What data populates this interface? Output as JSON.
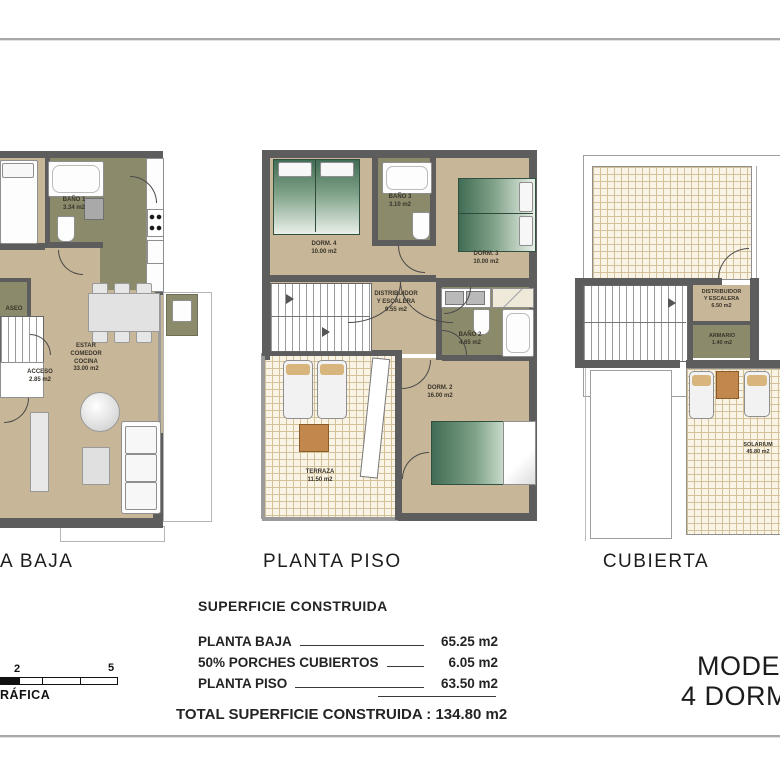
{
  "plans": {
    "baja": {
      "title": "A BAJA",
      "labels": {
        "bano1": "BAÑO 1\n3.34 m2",
        "aseo": "ASEO",
        "acceso": "ACCESO\n2.85 m2",
        "estar": "ESTAR\nCOMEDOR\nCOCINA\n33.00 m2"
      }
    },
    "piso": {
      "title": "PLANTA PISO",
      "labels": {
        "dorm4": "DORM. 4\n10.00 m2",
        "bano3": "BAÑO 3\n3.10 m2",
        "dorm3": "DORM. 3\n10.00 m2",
        "distribuidor": "DISTRIBUIDOR\nY ESCALERA\n9.55 m2",
        "bano2": "BAÑO 2\n4.65 m2",
        "dorm2": "DORM. 2\n16.00 m2",
        "terraza": "TERRAZA\n11.50 m2"
      }
    },
    "cubierta": {
      "title": "CUBIERTA",
      "labels": {
        "distribuidor": "DISTRIBUIDOR\nY ESCALERA\n6.50 m2",
        "armario": "ARMARIO\n1.40 m2",
        "solarium": "SOLARIUM\n45.80 m2"
      }
    }
  },
  "summary": {
    "title": "SUPERFICIE CONSTRUIDA",
    "rows": [
      {
        "label": "PLANTA BAJA",
        "value": "65.25 m2"
      },
      {
        "label": "50% PORCHES CUBIERTOS",
        "value": "6.05 m2"
      },
      {
        "label": "PLANTA PISO",
        "value": "63.50 m2"
      }
    ],
    "total": "TOTAL SUPERFICIE CONSTRUIDA : 134.80 m2"
  },
  "model": {
    "line1": "MODELO",
    "line2": "4 DORMIT"
  },
  "scale_bar": {
    "tick_2": "2",
    "tick_5": "5",
    "label": "RÁFICA"
  }
}
